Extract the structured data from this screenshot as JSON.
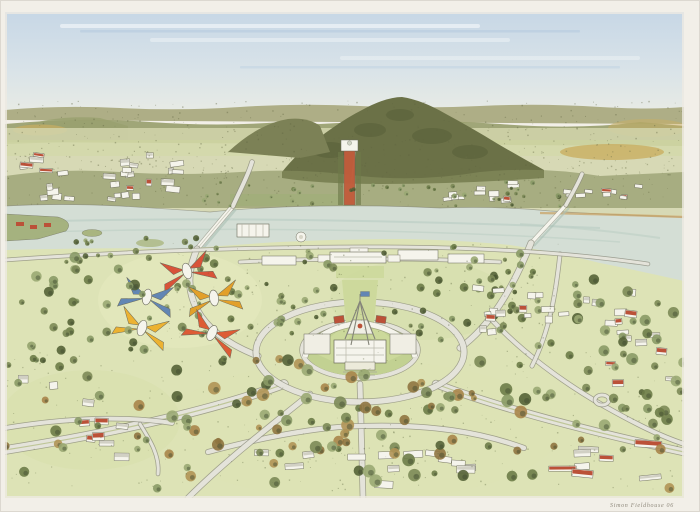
{
  "artwork": {
    "signature": "Simon Fieldhouse 06"
  },
  "scene": {
    "landmarks": [
      "sky",
      "distant-hills",
      "mount-ainslie",
      "anzac-parade",
      "australian-war-memorial",
      "lake-burley-griffin",
      "commonwealth-avenue-bridge",
      "kings-avenue-bridge",
      "acton-peninsula",
      "city-centre",
      "old-parliament-house",
      "national-library",
      "parliament-house",
      "flag-mast",
      "state-circle",
      "capital-circle",
      "colored-pavilions",
      "parklands",
      "suburbs"
    ]
  },
  "palette": {
    "paper": "#f2efe8",
    "sky_top": "#c7d7e6",
    "sky_mid": "#d9e3e8",
    "sky_bottom": "#eaece4",
    "hills_far": "#aeae86",
    "hills_mid": "#99a06e",
    "mountain": "#6b7147",
    "mountain_shadow": "#545b35",
    "field_tan": "#c9ae62",
    "midground": "#d2d5ac",
    "tree_band": "#87905f",
    "lake": "#d4ded5",
    "lake_streak": "#bccfc4",
    "lawn": "#dde3b6",
    "lawn_bright": "#cdd99c",
    "parliament_lawn": "#c2d192",
    "road_fill": "#e4e3da",
    "road_edge": "#8a8a7b",
    "building_white": "#f5f4ec",
    "building_shadow": "#b9b8aa",
    "roof_red": "#bb5138",
    "anzac_red": "#c25b3b",
    "peninsula_green": "#a3b07b",
    "accent_red": "#d85339",
    "accent_blue": "#6286b4",
    "accent_yellow": "#ecb232",
    "accent_gold": "#e2a02a",
    "accent_orange": "#dd5b35",
    "ink": "#6b6b5a",
    "signature_ink": "#8f897c"
  }
}
